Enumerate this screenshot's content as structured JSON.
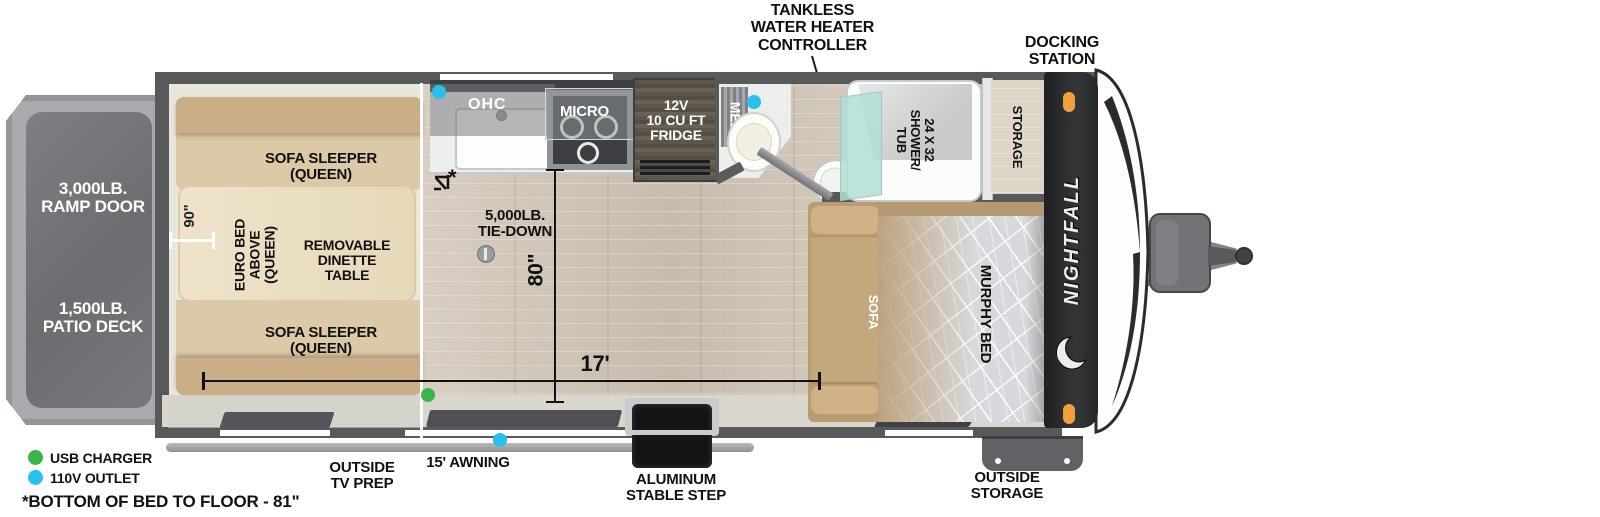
{
  "colors": {
    "usb_green": "#3bb54a",
    "outlet_cyan": "#29bfef",
    "marker_orange": "#f0a13e",
    "wall_gray": "#58595b",
    "brand_black": "#27292b"
  },
  "labels": {
    "tankless": "TANKLESS\nWATER HEATER\nCONTROLLER",
    "docking": "DOCKING\nSTATION",
    "ramp": "3,000LB.\nRAMP DOOR",
    "patio": "1,500LB.\nPATIO DECK",
    "sofa_sleeper_top": "SOFA SLEEPER\n(QUEEN)",
    "sofa_sleeper_bottom": "SOFA SLEEPER\n(QUEEN)",
    "euro_bed": "EURO BED\nABOVE\n(QUEEN)",
    "dinette": "REMOVABLE\nDINETTE\nTABLE",
    "ohc": "OHC",
    "micro": "MICRO",
    "fridge": "12V\n10 CU FT\nFRIDGE",
    "med": "MED",
    "shower": "24 X 32\nSHOWER/\nTUB",
    "storage": "STORAGE",
    "sofa": "SOFA",
    "murphy": "MURPHY BED",
    "brand": "NIGHTFALL",
    "tie_down": "5,000LB.\nTIE-DOWN",
    "outside_tv": "OUTSIDE\nTV PREP",
    "awning": "15' AWNING",
    "step": "ALUMINUM\nSTABLE STEP",
    "outside_storage": "OUTSIDE\nSTORAGE",
    "dim_90": "90\"",
    "dim_80": "80\"",
    "dim_17": "17'",
    "asterisk": "*",
    "legend_usb": "USB CHARGER",
    "legend_110v": "110V OUTLET",
    "note": "*BOTTOM OF BED TO FLOOR - 81\""
  }
}
